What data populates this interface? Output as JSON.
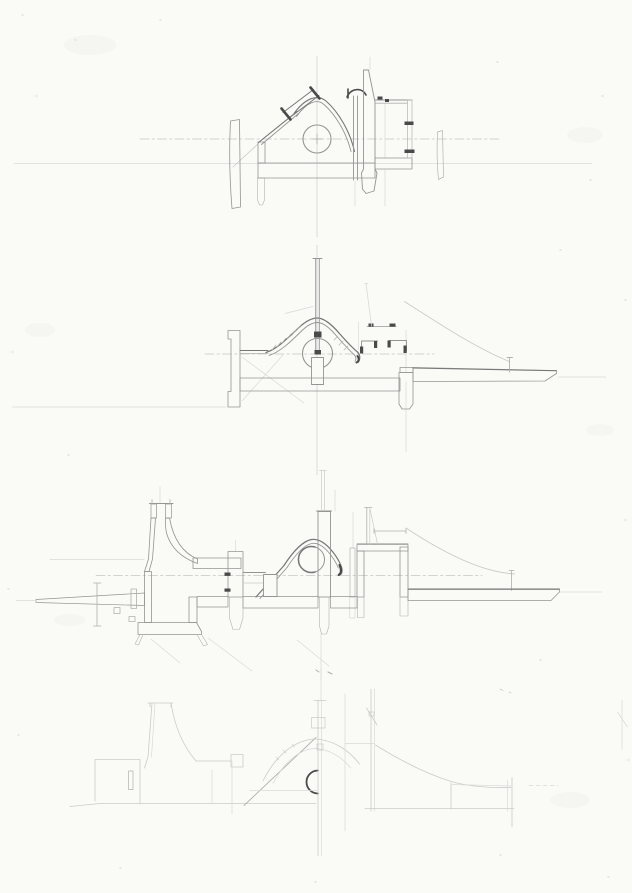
{
  "sheet": {
    "kind": "pencil architectural section studies",
    "description": "Hand-drawn graphite sheet with four stacked section studies of a small building complex: an upper vaulted section with tilted skylight and circular oculus, a middle domed section with a tall mast, a long composite section with a flared funnel tower, sunken pit, arched vault and box room, and a faint construction-line underlay at the bottom."
  },
  "colors": {
    "paper": "#fafaf7",
    "graphite": "#777777",
    "graphite_medium": "#949494",
    "graphite_light": "#b0b0b0",
    "graphite_faint": "#cbcbcb",
    "graphite_ghost": "#d9d9d9",
    "graphite_dark": "#4a4a4a",
    "hatch_line": "#8f8f8f",
    "hatch_bg": "#e9e9e6",
    "hatch_line_light": "#b3b3b3",
    "hatch_bg_light": "#f1f1ee",
    "centerline": "#c6c6c6"
  },
  "panels": [
    {
      "id": "section-1",
      "label": "upper section study: quarter-dome shell with tilted skylight, oculus circle, hatched piers, side room and floor slab"
    },
    {
      "id": "section-2",
      "label": "middle section study: low dome with tall mast over oculus, stepped roof channels, cantilevered tapering ground slab"
    },
    {
      "id": "section-3",
      "label": "long composite section: flared funnel tower with sunken pit, central piers, arched vault over oculus, box room, runway slab"
    },
    {
      "id": "section-4",
      "label": "faint construction-line underlay of the composite section with dark half-circle oculus mark"
    }
  ]
}
